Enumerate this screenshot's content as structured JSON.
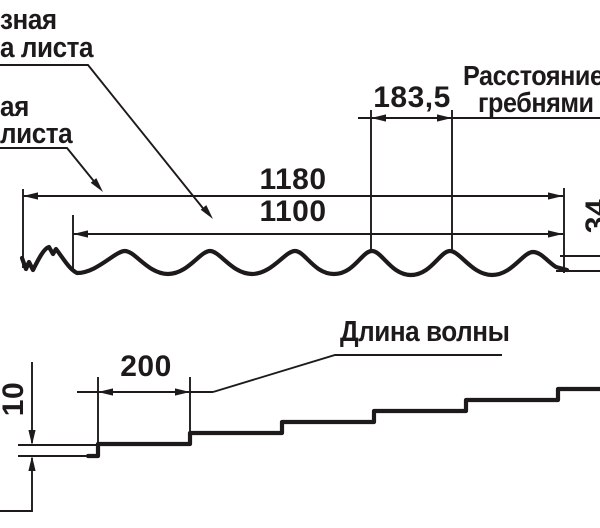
{
  "canvas": {
    "width": 600,
    "height": 528,
    "background": "#ffffff",
    "ink_color": "#1e1a1a"
  },
  "top_diagram": {
    "label_useful_width_fragment": {
      "line1": "зная",
      "line2": "а листа"
    },
    "label_total_width_fragment": {
      "line1": "ая",
      "line2": "листа"
    },
    "label_crest_distance_fragment": {
      "line1": "Расстояние",
      "line2": "гребнями в"
    },
    "dim_crest_spacing": "183,5",
    "dim_total_width": "1180",
    "dim_useful_width": "1100",
    "dim_profile_height": "34"
  },
  "bottom_diagram": {
    "label_wave_length": "Длина волны",
    "dim_wave_length": "200",
    "dim_step_height": "10"
  }
}
